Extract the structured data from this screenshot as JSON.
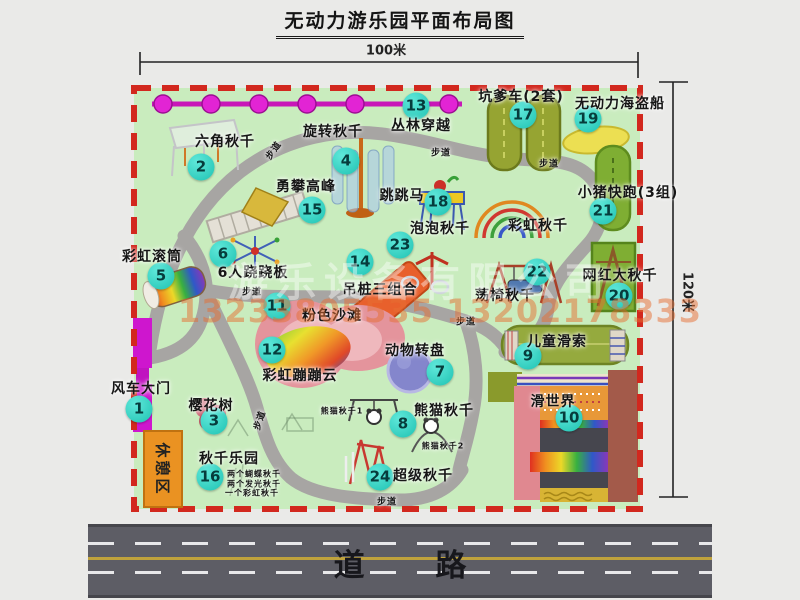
{
  "title": "无动力游乐园平面布局图",
  "dimensions": {
    "top": "100米",
    "right": "120米"
  },
  "road_label": "道 路",
  "rest_area_label": "休憩区",
  "watermark": {
    "company": "游乐设备有限公司",
    "phone": "13233805535 13202178333"
  },
  "colors": {
    "park_green": "#c9ecbe",
    "border_red": "#d2281e",
    "badge_teal": "#2fd0c0",
    "road_gray": "#5d5d65",
    "gate_magenta": "#ce16ce",
    "zipline_magenta": "#e224d4",
    "path_gray": "#a7a5a3"
  },
  "map": {
    "attractions": [
      {
        "num": "1",
        "name": "风车大门",
        "bx": 139,
        "by": 409,
        "lx": 141,
        "ly": 388
      },
      {
        "num": "2",
        "name": "六角秋千",
        "bx": 201,
        "by": 167,
        "lx": 225,
        "ly": 141
      },
      {
        "num": "3",
        "name": "樱花树",
        "bx": 214,
        "by": 421,
        "lx": 211,
        "ly": 405
      },
      {
        "num": "4",
        "name": "旋转秋千",
        "bx": 346,
        "by": 161,
        "lx": 333,
        "ly": 131
      },
      {
        "num": "5",
        "name": "彩虹滚筒",
        "bx": 161,
        "by": 276,
        "lx": 152,
        "ly": 256
      },
      {
        "num": "6",
        "name": "6人跷跷板",
        "bx": 223,
        "by": 254,
        "lx": 253,
        "ly": 272
      },
      {
        "num": "7",
        "name": "动物转盘",
        "bx": 440,
        "by": 372,
        "lx": 415,
        "ly": 350
      },
      {
        "num": "8",
        "name": "熊猫秋千",
        "bx": 403,
        "by": 424,
        "lx": 444,
        "ly": 410
      },
      {
        "num": "9",
        "name": "儿童滑索",
        "bx": 528,
        "by": 356,
        "lx": 557,
        "ly": 341
      },
      {
        "num": "10",
        "name": "滑世界",
        "bx": 569,
        "by": 418,
        "lx": 553,
        "ly": 401
      },
      {
        "num": "11",
        "name": "粉色沙滩",
        "bx": 277,
        "by": 306,
        "lx": 332,
        "ly": 315
      },
      {
        "num": "12",
        "name": "彩虹蹦蹦云",
        "bx": 272,
        "by": 350,
        "lx": 300,
        "ly": 375
      },
      {
        "num": "13",
        "name": "丛林穿越",
        "bx": 416,
        "by": 106,
        "lx": 421,
        "ly": 125
      },
      {
        "num": "14",
        "name": "吊桩三组合",
        "bx": 360,
        "by": 262,
        "lx": 380,
        "ly": 289
      },
      {
        "num": "15",
        "name": "勇攀高峰",
        "bx": 312,
        "by": 210,
        "lx": 306,
        "ly": 186
      },
      {
        "num": "16",
        "name": "秋千乐园",
        "bx": 210,
        "by": 477,
        "lx": 229,
        "ly": 458
      },
      {
        "num": "17",
        "name": "坑爹车(2套)",
        "bx": 523,
        "by": 115,
        "lx": 521,
        "ly": 96
      },
      {
        "num": "18",
        "name": "跳跳马",
        "bx": 438,
        "by": 202,
        "lx": 402,
        "ly": 195
      },
      {
        "num": "19",
        "name": "无动力海盗船",
        "bx": 588,
        "by": 119,
        "lx": 620,
        "ly": 103
      },
      {
        "num": "20",
        "name": "网红大秋千",
        "bx": 619,
        "by": 296,
        "lx": 620,
        "ly": 275
      },
      {
        "num": "21",
        "name": "小猪快跑(3组)",
        "bx": 603,
        "by": 211,
        "lx": 628,
        "ly": 192
      },
      {
        "num": "22",
        "name": "荡椅秋千",
        "bx": 537,
        "by": 272,
        "lx": 505,
        "ly": 295
      },
      {
        "num": "23",
        "name": "泡泡秋千",
        "bx": 400,
        "by": 245,
        "lx": 440,
        "ly": 228
      },
      {
        "num": "24",
        "name": "超级秋千",
        "bx": 380,
        "by": 477,
        "lx": 423,
        "ly": 475
      }
    ],
    "extra_labels": [
      {
        "text": "彩虹秋千",
        "x": 538,
        "y": 225,
        "fs": 14
      },
      {
        "text": "熊猫秋千1",
        "x": 342,
        "y": 411,
        "fs": 8
      },
      {
        "text": "熊猫秋千2",
        "x": 443,
        "y": 446,
        "fs": 8
      },
      {
        "text": "两个蝴蝶秋千",
        "x": 254,
        "y": 474,
        "fs": 8
      },
      {
        "text": "两个发光秋千",
        "x": 254,
        "y": 484,
        "fs": 8
      },
      {
        "text": "一个彩虹秋千",
        "x": 252,
        "y": 493,
        "fs": 8
      },
      {
        "text": "步道",
        "x": 273,
        "y": 150,
        "fs": 9,
        "rot": -55
      },
      {
        "text": "步道",
        "x": 441,
        "y": 152,
        "fs": 9
      },
      {
        "text": "步道",
        "x": 549,
        "y": 163,
        "fs": 9
      },
      {
        "text": "步道",
        "x": 252,
        "y": 291,
        "fs": 9
      },
      {
        "text": "步道",
        "x": 259,
        "y": 420,
        "fs": 9,
        "rot": -72
      },
      {
        "text": "步道",
        "x": 387,
        "y": 501,
        "fs": 9
      },
      {
        "text": "步道",
        "x": 466,
        "y": 321,
        "fs": 9
      }
    ]
  }
}
